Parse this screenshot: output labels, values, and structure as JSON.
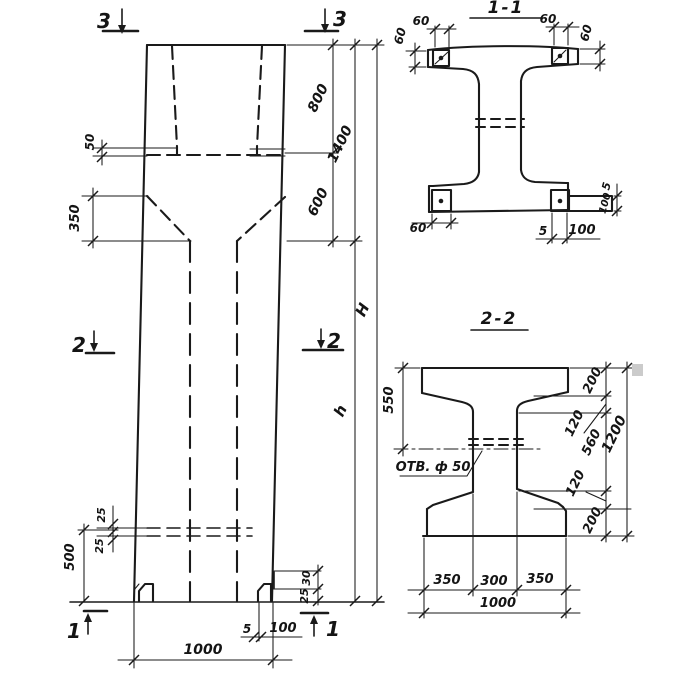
{
  "colors": {
    "ink": "#1a1a1a",
    "paper": "#ffffff",
    "artifact": "#cbcbcb"
  },
  "elevation": {
    "marker_top_left": "3",
    "marker_top_right": "3",
    "marker_mid_left": "2",
    "marker_mid_right": "2",
    "marker_bottom_left": "1",
    "marker_bottom_right": "1",
    "dim_50": "50",
    "dim_350": "350",
    "dim_25_upper": "25",
    "dim_25_lower": "25",
    "dim_500": "500",
    "dim_800": "800",
    "dim_600": "600",
    "dim_1400": "1400",
    "dim_h": "h",
    "dim_H": "H",
    "dim_1000": "1000",
    "dim_5": "5",
    "dim_100": "100",
    "dim_30": "30",
    "dim_25_foot": "25"
  },
  "section_1_1": {
    "title": "1-1",
    "dim_60_top_left": "60",
    "dim_60_top_right": "60",
    "dim_60_left": "60",
    "dim_60_right": "60",
    "dim_60_bottom": "60",
    "dim_5_bottom": "5",
    "dim_100_bottom": "100",
    "dim_5_right": "5",
    "dim_100_right": "100"
  },
  "section_2_2": {
    "title": "2-2",
    "hole_label": "ОТВ. ф 50",
    "dim_550": "550",
    "dim_200_top": "200",
    "dim_120_top": "120",
    "dim_560": "560",
    "dim_120_bottom": "120",
    "dim_200_bottom": "200",
    "dim_1200": "1200",
    "dim_350_left": "350",
    "dim_300": "300",
    "dim_350_right": "350",
    "dim_1000": "1000"
  }
}
